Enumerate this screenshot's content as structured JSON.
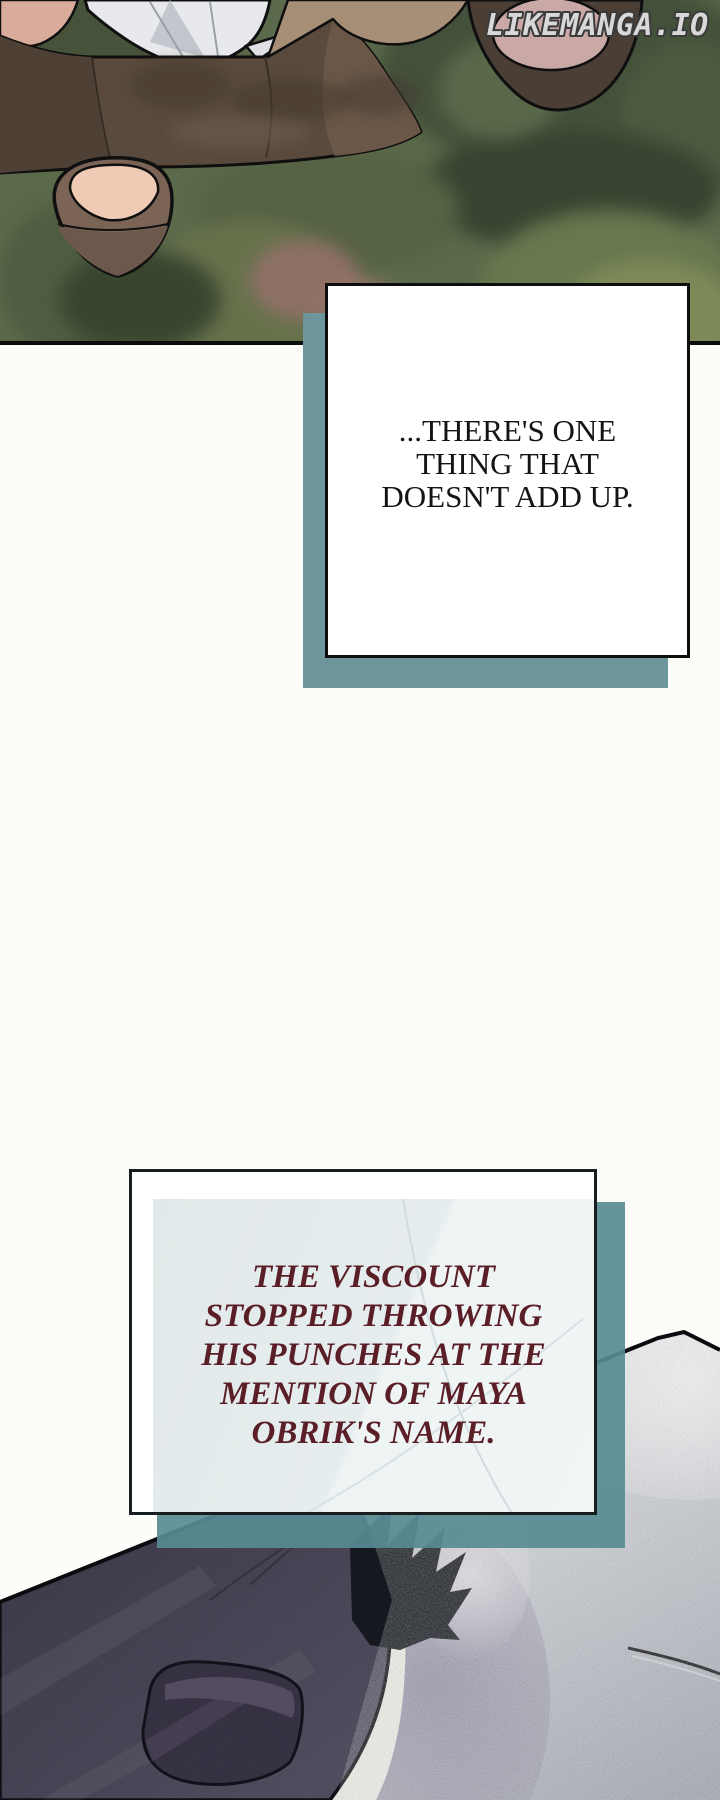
{
  "watermark": {
    "text": "LIKEMANGA.IO"
  },
  "speech_box": {
    "lines": [
      "...THERE'S ONE",
      "THING THAT",
      "DOESN'T ADD UP."
    ]
  },
  "narration_box": {
    "lines": [
      "THE VISCOUNT",
      "STOPPED THROWING",
      "HIS PUNCHES AT THE",
      "MENTION OF MAYA",
      "OBRIK'S NAME."
    ]
  },
  "colors": {
    "box_shadow_teal": "#6d959c",
    "speech_text": "#141414",
    "narration_text": "#5a1e26",
    "panel_border": "#0c0c0c",
    "watermark_fill": "#d8d8d8",
    "watermark_outline": "#3b3b3b"
  }
}
